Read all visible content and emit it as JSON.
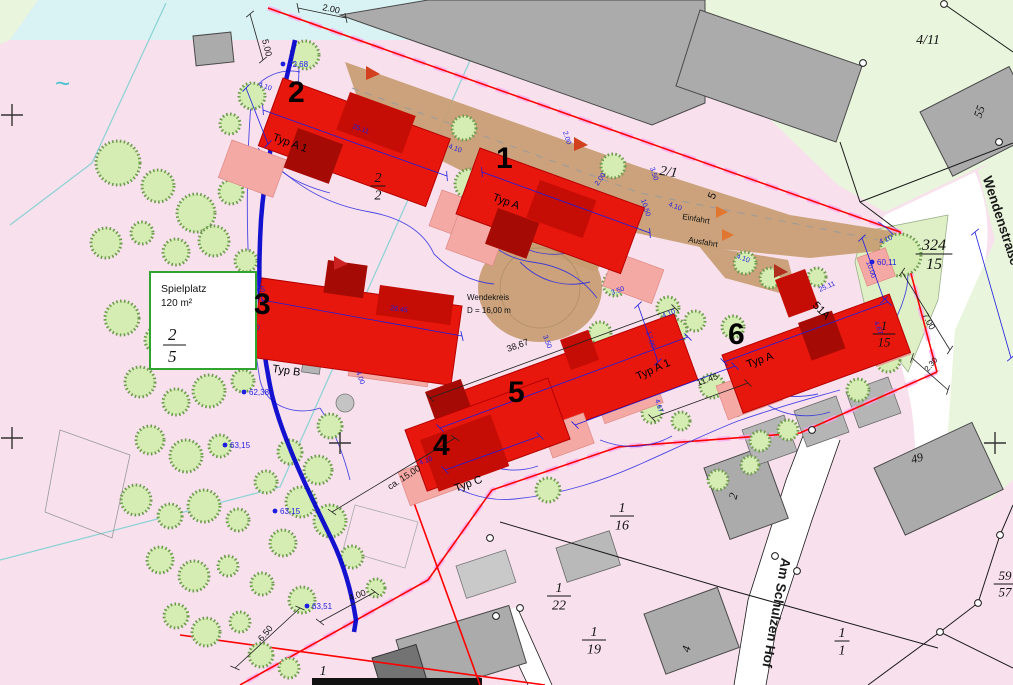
{
  "colors": {
    "background_pink": "#f8e1ed",
    "water_cyan_area": "#d9f2f3",
    "green_area": "#e9f5dc",
    "green_parcel": "#dff0c6",
    "existing_building_gray": "#ababab",
    "new_building_red": "#e8170d",
    "roof_dark_red": "#c50c05",
    "terrace_pink": "#f4a9a5",
    "driveway_tan": "#c79d72",
    "boundary_red": "#ff0000",
    "boundary_magenta_dash": "#f9a2ef",
    "dimension_blue": "#1d1de0",
    "pipe_blue": "#0000cc",
    "tree_green": "#d5edb2"
  },
  "site": {
    "playground": {
      "title": "Spielplatz",
      "area": "120 m²",
      "parcel_num": "2",
      "parcel_den": "5"
    },
    "turning_circle": {
      "name": "Wendekreis",
      "diameter": "D = 16,00 m"
    },
    "access": {
      "entry": "Einfahrt",
      "exit": "Ausfahrt",
      "point_no": "5"
    },
    "streets": {
      "south": "Am Schulzen Hof",
      "east": "Wendenstraße"
    },
    "buildings": [
      {
        "no": "1",
        "type": "Typ A"
      },
      {
        "no": "2",
        "type": "Typ A 1"
      },
      {
        "no": "3",
        "type": "Typ B"
      },
      {
        "no": "4",
        "type": "Typ C"
      },
      {
        "no": "5",
        "type": "Typ A 1"
      },
      {
        "no": "6",
        "type": "Typ A",
        "house_no": "51A"
      }
    ],
    "house_numbers": [
      {
        "t": "55",
        "x": 983,
        "y": 113,
        "r": -70,
        "fs": 12
      },
      {
        "t": "49",
        "x": 918,
        "y": 462,
        "r": -15,
        "fs": 12
      },
      {
        "t": "2",
        "x": 737,
        "y": 497,
        "r": -75,
        "fs": 12
      },
      {
        "t": "4",
        "x": 690,
        "y": 650,
        "r": -75,
        "fs": 12
      }
    ],
    "parcels": [
      {
        "num": "2",
        "den": "2",
        "x": 378,
        "y": 182,
        "fs": 14
      },
      {
        "t": "2/1",
        "x": 668,
        "y": 176,
        "r": 8,
        "fs": 14
      },
      {
        "t": "4/11",
        "x": 928,
        "y": 44,
        "r": 0,
        "fs": 14
      },
      {
        "num": "324",
        "den": "15",
        "x": 934,
        "y": 250,
        "fs": 16
      },
      {
        "num": "1",
        "den": "15",
        "x": 884,
        "y": 330,
        "fs": 13
      },
      {
        "num": "1",
        "den": "16",
        "x": 622,
        "y": 512,
        "fs": 14
      },
      {
        "num": "1",
        "den": "22",
        "x": 559,
        "y": 592,
        "fs": 14
      },
      {
        "num": "1",
        "den": "19",
        "x": 594,
        "y": 636,
        "fs": 14
      },
      {
        "num": "1",
        "den": "1",
        "x": 842,
        "y": 637,
        "fs": 14
      },
      {
        "num": "59",
        "den": "57",
        "x": 1005,
        "y": 580,
        "fs": 13
      },
      {
        "t": "1",
        "x": 323,
        "y": 675,
        "r": 0,
        "fs": 14,
        "u": true
      }
    ],
    "dims": [
      {
        "t": "5.00",
        "x": 262,
        "y": 40,
        "r": 76,
        "c": "k",
        "s": 9
      },
      {
        "t": "2.00",
        "x": 322,
        "y": 10,
        "r": 12,
        "c": "k",
        "s": 9
      },
      {
        "t": "4.10",
        "x": 258,
        "y": 86,
        "r": 20,
        "c": "b"
      },
      {
        "t": "25.11",
        "x": 352,
        "y": 128,
        "r": 20,
        "c": "b"
      },
      {
        "t": "4.10",
        "x": 448,
        "y": 148,
        "r": 20,
        "c": "b"
      },
      {
        "t": "2.00",
        "x": 563,
        "y": 132,
        "r": 72,
        "c": "b"
      },
      {
        "t": "3.50",
        "x": 650,
        "y": 168,
        "r": 72,
        "c": "b"
      },
      {
        "t": "10.50",
        "x": 641,
        "y": 200,
        "r": 72,
        "c": "b"
      },
      {
        "t": "4.10",
        "x": 668,
        "y": 206,
        "r": 20,
        "c": "b"
      },
      {
        "t": "2.00",
        "x": 598,
        "y": 186,
        "r": -55,
        "c": "b"
      },
      {
        "t": "4.10",
        "x": 736,
        "y": 258,
        "r": 20,
        "c": "b"
      },
      {
        "t": "26.45",
        "x": 390,
        "y": 310,
        "r": 8,
        "c": "b"
      },
      {
        "t": "4.00",
        "x": 246,
        "y": 328,
        "r": 8,
        "c": "b"
      },
      {
        "t": "4.00",
        "x": 356,
        "y": 372,
        "r": 70,
        "c": "b"
      },
      {
        "t": "38,67",
        "x": 508,
        "y": 352,
        "r": -20,
        "c": "k",
        "s": 9
      },
      {
        "t": "3.50",
        "x": 543,
        "y": 336,
        "r": 70,
        "c": "b"
      },
      {
        "t": "3.50",
        "x": 612,
        "y": 295,
        "r": -20,
        "c": "b"
      },
      {
        "t": "17.00",
        "x": 646,
        "y": 332,
        "r": 72,
        "c": "b"
      },
      {
        "t": "4.10",
        "x": 663,
        "y": 318,
        "r": -20,
        "c": "b"
      },
      {
        "t": "11.45",
        "x": 698,
        "y": 386,
        "r": -20,
        "c": "k",
        "s": 9
      },
      {
        "t": "4.67",
        "x": 655,
        "y": 400,
        "r": 72,
        "c": "b"
      },
      {
        "t": "4.10",
        "x": 420,
        "y": 465,
        "r": -20,
        "c": "b"
      },
      {
        "t": "ca. 15,00",
        "x": 390,
        "y": 490,
        "r": -33,
        "c": "k",
        "s": 9
      },
      {
        "t": "6.50",
        "x": 262,
        "y": 642,
        "r": -50,
        "c": "k",
        "s": 9
      },
      {
        "t": "4.00",
        "x": 350,
        "y": 601,
        "r": -20,
        "c": "k",
        "s": 9
      },
      {
        "t": "7.00",
        "x": 922,
        "y": 315,
        "r": 62,
        "c": "k",
        "s": 9
      },
      {
        "t": "2.30",
        "x": 928,
        "y": 372,
        "r": -50,
        "c": "k",
        "s": 8
      },
      {
        "t": "10.00",
        "x": 866,
        "y": 262,
        "r": 70,
        "c": "b"
      },
      {
        "t": "4.10",
        "x": 880,
        "y": 244,
        "r": -20,
        "c": "b"
      },
      {
        "t": "25.11",
        "x": 820,
        "y": 292,
        "r": -24,
        "c": "b"
      },
      {
        "t": "4.67",
        "x": 874,
        "y": 322,
        "r": 70,
        "c": "b"
      }
    ],
    "elevations": [
      {
        "t": "62,68",
        "x": 283,
        "y": 64
      },
      {
        "t": "62,45",
        "x": 240,
        "y": 289
      },
      {
        "t": "62,38",
        "x": 244,
        "y": 392
      },
      {
        "t": "63,15",
        "x": 225,
        "y": 445
      },
      {
        "t": "63,15",
        "x": 275,
        "y": 511
      },
      {
        "t": "63,51",
        "x": 307,
        "y": 606
      },
      {
        "t": "60,11",
        "x": 872,
        "y": 262
      }
    ],
    "dimlines": [
      {
        "x1": 263,
        "y1": 110,
        "x2": 447,
        "y2": 176,
        "c": "b"
      },
      {
        "x1": 482,
        "y1": 172,
        "x2": 650,
        "y2": 233,
        "c": "b"
      },
      {
        "x1": 262,
        "y1": 300,
        "x2": 462,
        "y2": 336,
        "c": "b"
      },
      {
        "x1": 430,
        "y1": 398,
        "x2": 675,
        "y2": 308,
        "c": "k"
      },
      {
        "x1": 440,
        "y1": 428,
        "x2": 688,
        "y2": 337,
        "c": "b"
      },
      {
        "x1": 724,
        "y1": 362,
        "x2": 888,
        "y2": 302,
        "c": "b"
      },
      {
        "x1": 975,
        "y1": 232,
        "x2": 1011,
        "y2": 358,
        "c": "b"
      },
      {
        "x1": 862,
        "y1": 238,
        "x2": 884,
        "y2": 300,
        "c": "b"
      },
      {
        "x1": 638,
        "y1": 305,
        "x2": 658,
        "y2": 362,
        "c": "b"
      },
      {
        "x1": 246,
        "y1": 88,
        "x2": 268,
        "y2": 144,
        "c": "b"
      },
      {
        "x1": 332,
        "y1": 512,
        "x2": 455,
        "y2": 438,
        "c": "k"
      },
      {
        "x1": 235,
        "y1": 668,
        "x2": 300,
        "y2": 608,
        "c": "k"
      },
      {
        "x1": 320,
        "y1": 622,
        "x2": 375,
        "y2": 592,
        "c": "k"
      },
      {
        "x1": 902,
        "y1": 272,
        "x2": 950,
        "y2": 350,
        "c": "k"
      },
      {
        "x1": 912,
        "y1": 358,
        "x2": 948,
        "y2": 390,
        "c": "k"
      },
      {
        "x1": 250,
        "y1": 14,
        "x2": 263,
        "y2": 60,
        "c": "k"
      },
      {
        "x1": 298,
        "y1": 8,
        "x2": 346,
        "y2": 18,
        "c": "k"
      },
      {
        "x1": 652,
        "y1": 418,
        "x2": 748,
        "y2": 383,
        "c": "k"
      },
      {
        "x1": 445,
        "y1": 470,
        "x2": 540,
        "y2": 436,
        "c": "b"
      },
      {
        "x1": 575,
        "y1": 425,
        "x2": 735,
        "y2": 366,
        "c": "b"
      }
    ],
    "crosses": [
      [
        12,
        115
      ],
      [
        12,
        438
      ],
      [
        340,
        443
      ],
      [
        995,
        443
      ]
    ],
    "survey_points": [
      [
        999,
        142
      ],
      [
        1000,
        535
      ],
      [
        978,
        603
      ],
      [
        940,
        632
      ],
      [
        775,
        556
      ],
      [
        797,
        571
      ],
      [
        496,
        616
      ],
      [
        520,
        608
      ],
      [
        863,
        63
      ],
      [
        944,
        4
      ],
      [
        490,
        538
      ],
      [
        812,
        430
      ]
    ],
    "trees": [
      [
        118,
        163,
        22
      ],
      [
        158,
        186,
        16
      ],
      [
        196,
        213,
        19
      ],
      [
        231,
        192,
        12
      ],
      [
        106,
        243,
        15
      ],
      [
        142,
        233,
        11
      ],
      [
        176,
        252,
        13
      ],
      [
        214,
        241,
        15
      ],
      [
        246,
        261,
        11
      ],
      [
        122,
        318,
        17
      ],
      [
        158,
        340,
        13
      ],
      [
        194,
        331,
        15
      ],
      [
        228,
        318,
        11
      ],
      [
        140,
        382,
        15
      ],
      [
        176,
        402,
        13
      ],
      [
        209,
        391,
        16
      ],
      [
        243,
        381,
        11
      ],
      [
        150,
        440,
        14
      ],
      [
        186,
        456,
        16
      ],
      [
        220,
        446,
        11
      ],
      [
        136,
        500,
        15
      ],
      [
        170,
        516,
        12
      ],
      [
        204,
        506,
        16
      ],
      [
        238,
        520,
        11
      ],
      [
        160,
        560,
        13
      ],
      [
        194,
        576,
        15
      ],
      [
        228,
        566,
        10
      ],
      [
        176,
        616,
        12
      ],
      [
        206,
        632,
        14
      ],
      [
        240,
        622,
        10
      ],
      [
        262,
        584,
        11
      ],
      [
        283,
        543,
        13
      ],
      [
        301,
        502,
        15
      ],
      [
        266,
        482,
        11
      ],
      [
        290,
        452,
        12
      ],
      [
        318,
        470,
        14
      ],
      [
        330,
        521,
        16
      ],
      [
        352,
        557,
        11
      ],
      [
        302,
        600,
        13
      ],
      [
        330,
        426,
        12
      ],
      [
        261,
        655,
        12
      ],
      [
        289,
        668,
        10
      ],
      [
        376,
        588,
        9
      ],
      [
        305,
        55,
        14
      ],
      [
        252,
        96,
        13
      ],
      [
        230,
        124,
        10
      ],
      [
        464,
        128,
        12
      ],
      [
        470,
        184,
        15
      ],
      [
        613,
        166,
        12
      ],
      [
        615,
        284,
        12
      ],
      [
        668,
        308,
        11
      ],
      [
        695,
        321,
        10
      ],
      [
        600,
        333,
        11
      ],
      [
        675,
        331,
        12
      ],
      [
        733,
        327,
        11
      ],
      [
        712,
        386,
        12
      ],
      [
        735,
        406,
        10
      ],
      [
        652,
        413,
        10
      ],
      [
        681,
        421,
        9
      ],
      [
        760,
        441,
        10
      ],
      [
        788,
        430,
        10
      ],
      [
        548,
        490,
        12
      ],
      [
        745,
        263,
        11
      ],
      [
        770,
        278,
        10
      ],
      [
        795,
        292,
        9
      ],
      [
        817,
        277,
        9
      ],
      [
        900,
        255,
        21
      ],
      [
        888,
        360,
        12
      ],
      [
        858,
        390,
        11
      ],
      [
        718,
        480,
        10
      ],
      [
        750,
        465,
        9
      ]
    ]
  }
}
